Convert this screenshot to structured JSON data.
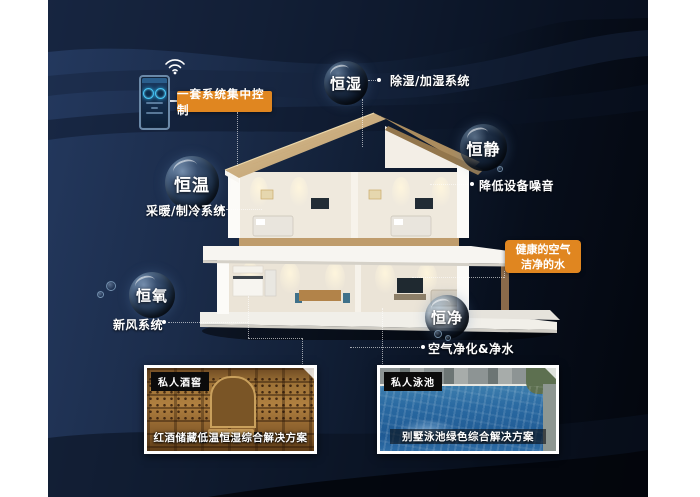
{
  "colors": {
    "accent_orange": "#E08620",
    "background_navy": "#1B2C4A",
    "tag_black": "#0B0B0B",
    "text_white": "#FFFFFF"
  },
  "control_panel": {
    "label": "一套系统集中控制",
    "device": "smart-wall-panel",
    "wifi_icon": "wifi"
  },
  "features": [
    {
      "name": "恒湿",
      "system": "除湿/加湿系统"
    },
    {
      "name": "恒静",
      "system": "降低设备噪音"
    },
    {
      "name": "恒温",
      "system": "采暖/制冷系统"
    },
    {
      "name": "恒氧",
      "system": "新风系统"
    },
    {
      "name": "恒净",
      "system": "空气净化&净水"
    }
  ],
  "highlight": {
    "line1": "健康的空气",
    "line2": "洁净的水"
  },
  "solutions": [
    {
      "tag": "私人酒窖",
      "caption": "红酒储藏低温恒湿综合解决方案"
    },
    {
      "tag": "私人泳池",
      "caption": "别墅泳池绿色综合解决方案"
    }
  ]
}
